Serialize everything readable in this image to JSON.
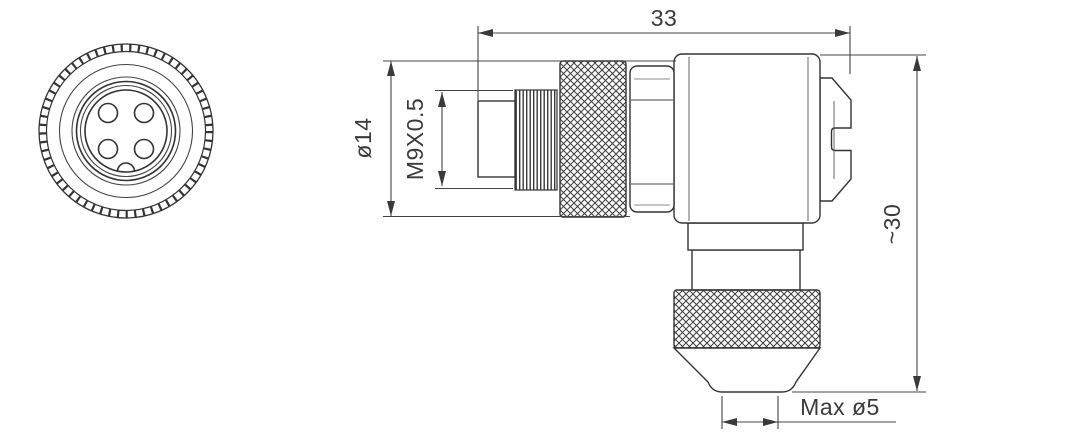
{
  "drawing": {
    "front_view": {
      "pin_count": 4,
      "features": [
        "knurled-outer-ring",
        "concentric-rings",
        "keying-notch-bottom"
      ]
    },
    "side_view": {
      "features": [
        "plug-tip",
        "m9-thread",
        "knurled-coupling-nut",
        "hex-flats",
        "right-angle-body",
        "back-screw-cap",
        "cable-gland-knurled-nut",
        "tapered-cable-exit"
      ]
    },
    "dimensions": {
      "overall_length": "33",
      "coupling_diameter": "ø14",
      "thread_spec": "M9X0.5",
      "overall_height": "~30",
      "max_cable_diameter": "Max ø5"
    },
    "colors": {
      "line": "#333333",
      "dimension_line": "#444444",
      "text": "#3a3a3a",
      "background": "#ffffff"
    }
  }
}
